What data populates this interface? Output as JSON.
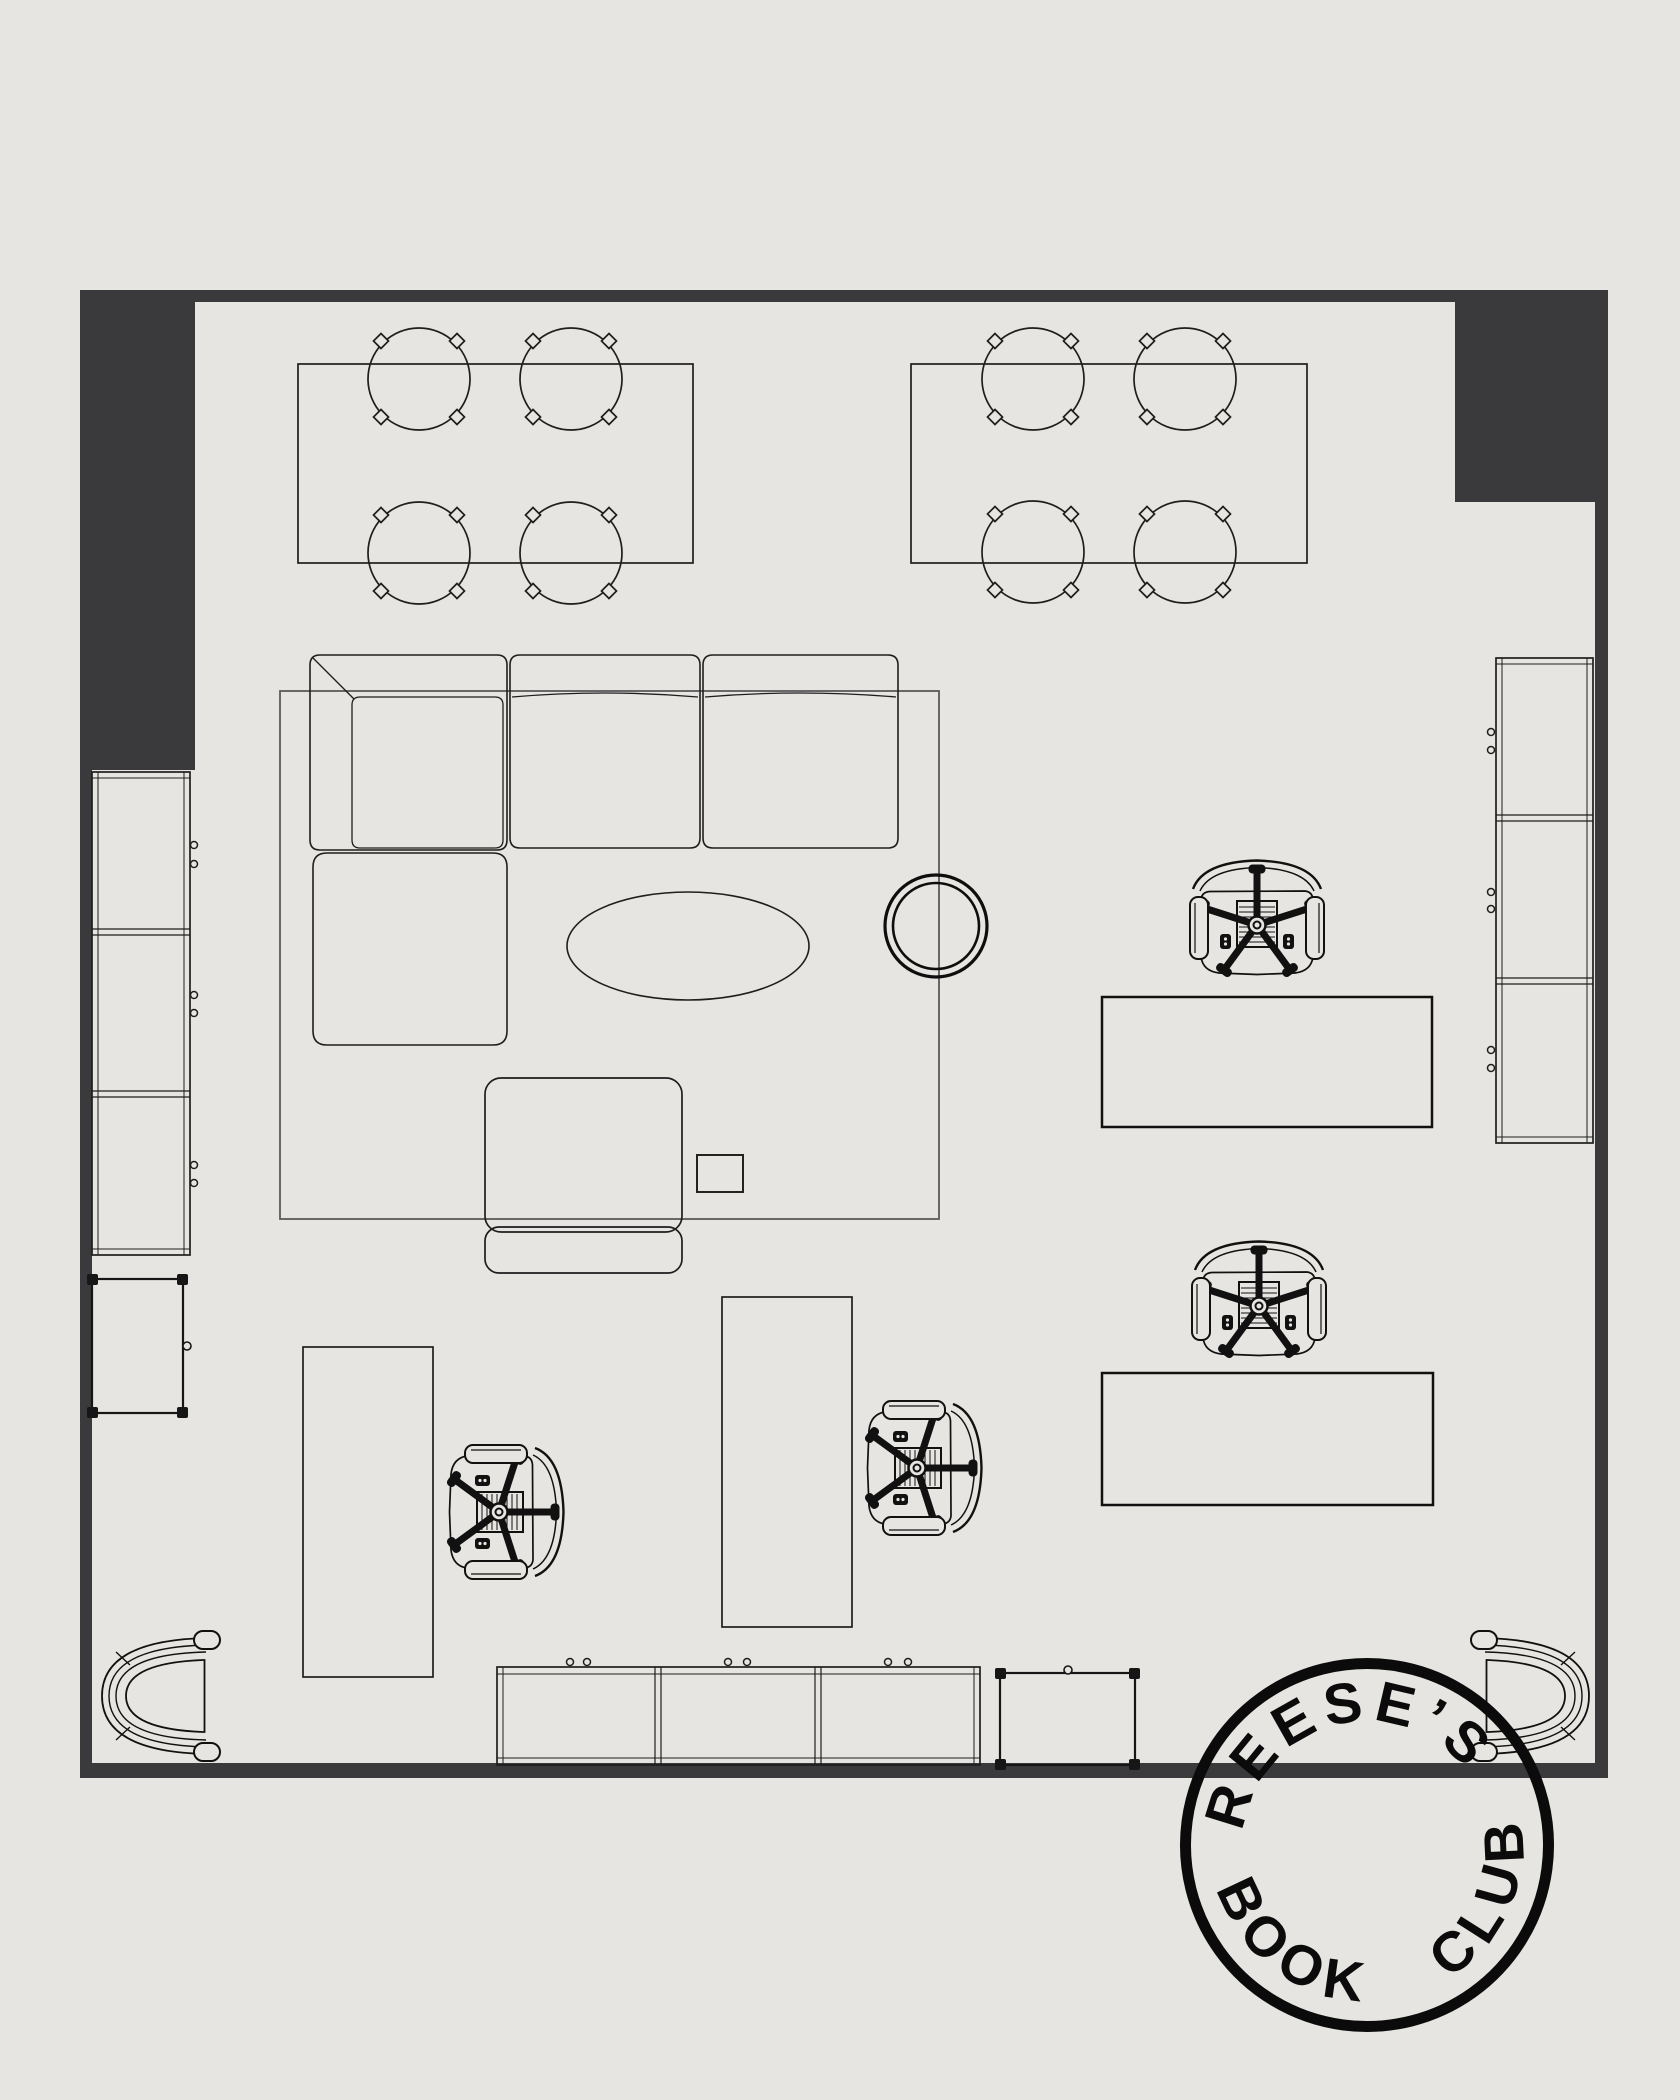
{
  "canvas": {
    "width": 1680,
    "height": 2100
  },
  "palette": {
    "bg": "#e7e5e1",
    "wall": "#3a3a3d",
    "line": "#1e1e1e",
    "soft": "#444444",
    "rug": "#5b5b5b",
    "stamp": "#0b0b0b"
  },
  "stamp": {
    "top_text": "REESE’S",
    "bottom_text": "BOOK CLUB"
  },
  "drawing": {
    "type": "floor-plan",
    "inventory": {
      "dining_tables": 2,
      "dining_chairs": 8,
      "sectional_sofa": 1,
      "lounge_seat_with_back": 1,
      "oval_coffee_table": 1,
      "round_side_table": 1,
      "square_side_table": 1,
      "area_rug": 1,
      "desks_vertical": 2,
      "desks_horizontal": 2,
      "office_task_chairs": 4,
      "tub_armchairs": 2,
      "wall_shelf_units": 2,
      "low_cabinets": 2,
      "bracket_tables": 2
    }
  }
}
